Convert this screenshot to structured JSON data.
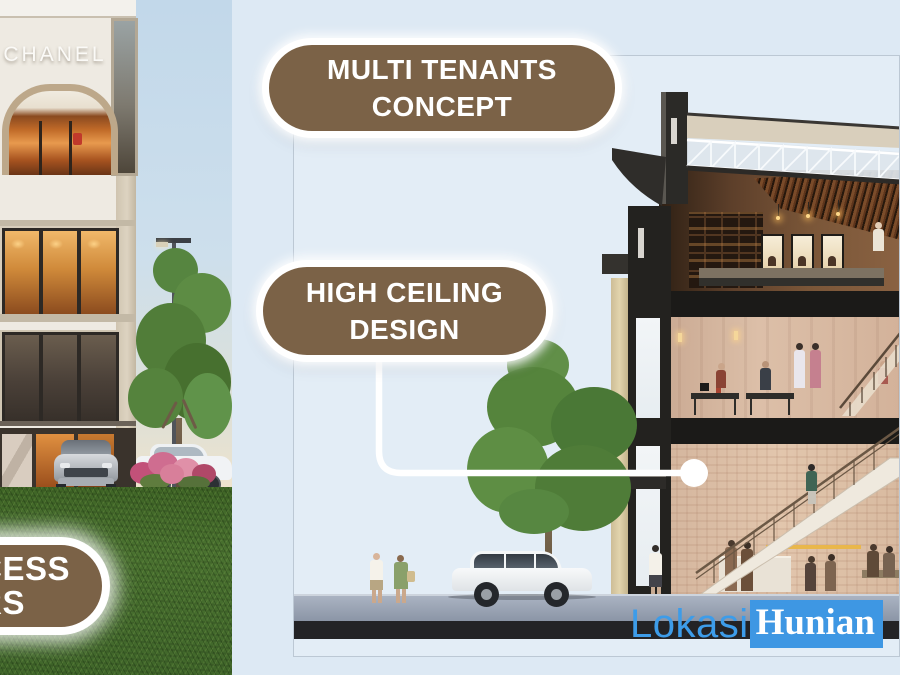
{
  "slide": {
    "width": 900,
    "height": 675
  },
  "badges": {
    "multi_tenants": {
      "line1": "MULTI TENANTS",
      "line2": "CONCEPT"
    },
    "high_ceiling": {
      "line1": "HIGH CEILING",
      "line2": "DESIGN"
    },
    "partial_left": {
      "line1": "CESS",
      "line2": "RS"
    }
  },
  "left_photo": {
    "signage": "CHANEL"
  },
  "watermark": {
    "part1": "Lokasi",
    "part2": "Hunian"
  },
  "colors": {
    "slide_background": "#dde9f4",
    "badge_fill": "#7b6247",
    "badge_border": "#ffffff",
    "badge_text": "#ffffff",
    "connector": "#ffffff",
    "watermark_text_blue": "#3d9ce9",
    "watermark_box_blue": "#3e97e3",
    "grass_green": "#436727",
    "roof_dark": "#2b2a27"
  }
}
